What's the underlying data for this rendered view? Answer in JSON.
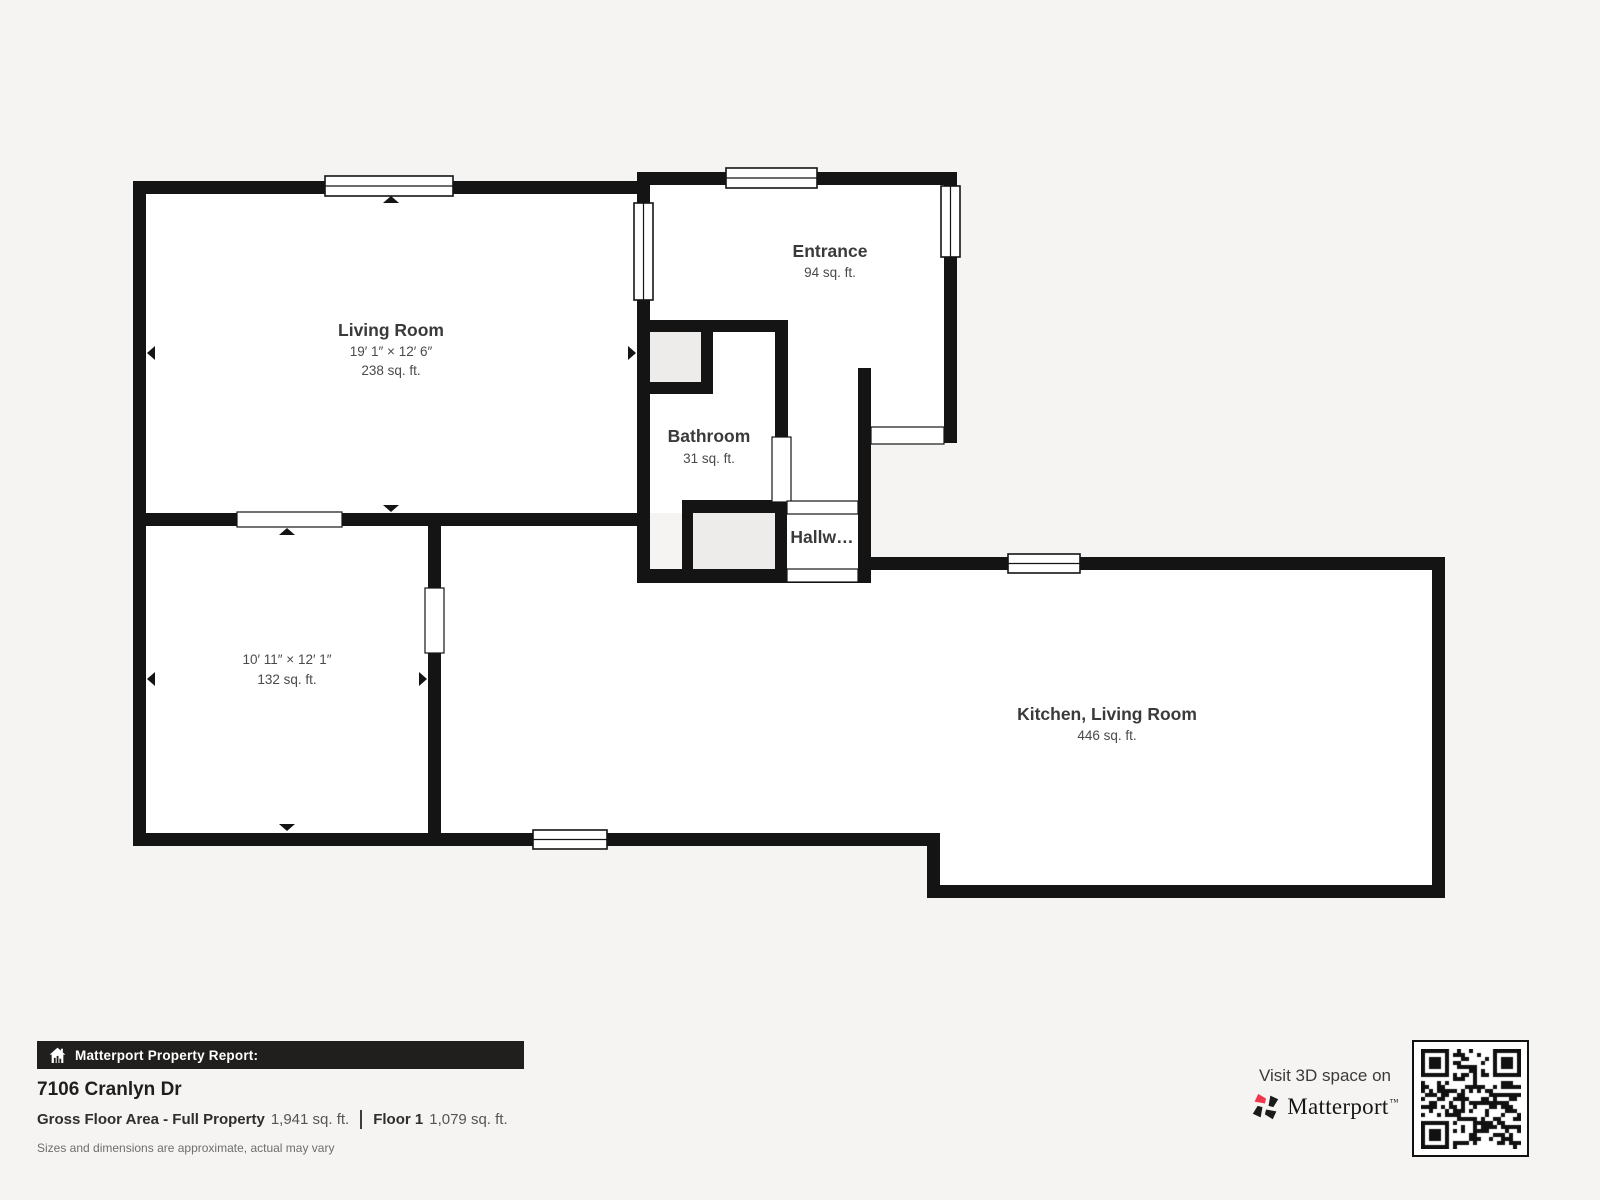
{
  "floor_plan": {
    "rooms": [
      {
        "id": "living-room",
        "name": "Living Room",
        "dimensions": "19′ 1″ × 12′ 6″",
        "area": "238 sq. ft."
      },
      {
        "id": "entrance",
        "name": "Entrance",
        "area": "94 sq. ft."
      },
      {
        "id": "bathroom",
        "name": "Bathroom",
        "area": "31 sq. ft."
      },
      {
        "id": "hallway",
        "name": "Hallw…"
      },
      {
        "id": "bedroom",
        "name": "",
        "dimensions": "10′ 11″ × 12′ 1″",
        "area": "132 sq. ft."
      },
      {
        "id": "kitchen-living-room",
        "name": "Kitchen, Living Room",
        "area": "446 sq. ft."
      }
    ]
  },
  "footer": {
    "report_label": "Matterport Property Report:",
    "address": "7106 Cranlyn Dr",
    "gross_label": "Gross Floor Area - Full Property",
    "gross_value": "1,941 sq. ft.",
    "floor_label": "Floor 1",
    "floor_value": "1,079 sq. ft.",
    "disclaimer": "Sizes and dimensions are approximate, actual may vary"
  },
  "branding": {
    "visit_text": "Visit 3D space on",
    "logo_text": "Matterport",
    "trademark": "™",
    "logo_red": "#f4364c"
  },
  "colors": {
    "wall": "#141414",
    "page_bg": "#f5f4f2",
    "room_fill": "#ffffff",
    "closet_fill": "#edecea",
    "report_bar_bg": "#211f1d"
  }
}
